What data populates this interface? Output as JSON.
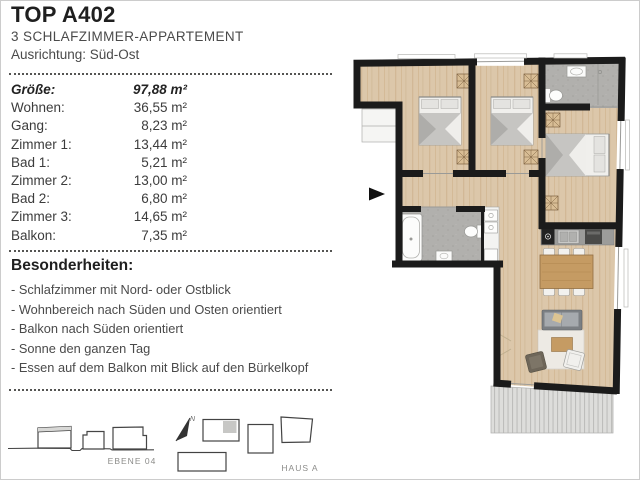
{
  "header": {
    "title": "TOP A402",
    "subtitle": "3 SCHLAFZIMMER-APPARTEMENT",
    "orientation": "Ausrichtung: Süd-Ost"
  },
  "sizes": {
    "rows": [
      {
        "label": "Größe:",
        "value": "97,88 m²",
        "emphasis": true
      },
      {
        "label": "Wohnen:",
        "value": "36,55 m²",
        "emphasis": false
      },
      {
        "label": "Gang:",
        "value": "8,23 m²",
        "emphasis": false
      },
      {
        "label": "Zimmer 1:",
        "value": "13,44 m²",
        "emphasis": false
      },
      {
        "label": "Bad 1:",
        "value": "5,21 m²",
        "emphasis": false
      },
      {
        "label": "Zimmer 2:",
        "value": "13,00 m²",
        "emphasis": false
      },
      {
        "label": "Bad 2:",
        "value": "6,80 m²",
        "emphasis": false
      },
      {
        "label": "Zimmer 3:",
        "value": "14,65 m²",
        "emphasis": false
      },
      {
        "label": "Balkon:",
        "value": "7,35 m²",
        "emphasis": false
      }
    ]
  },
  "features": {
    "title": "Besonderheiten:",
    "items": [
      "Schlafzimmer mit Nord- oder Ostblick",
      "Wohnbereich nach Süden und Osten orientiert",
      "Balkon nach Süden orientiert",
      "Sonne den ganzen Tag",
      "Essen auf dem Balkon mit Blick auf den Bürkelkopf"
    ]
  },
  "site": {
    "level_label": "EBENE 04",
    "house_label": "HAUS A",
    "north_label": "N"
  },
  "floorplan_palette": {
    "wall": "#1b1b1b",
    "wood_floor": "#dcc7aa",
    "wood_streak": "#cfb491",
    "bath_tile": "#b1b0ad",
    "table_wood": "#c59b63",
    "sofa_grey": "#7b7f83",
    "deck_grey": "#dddddb",
    "sketch_line": "#454545",
    "label_grey": "#8c8c8a"
  }
}
